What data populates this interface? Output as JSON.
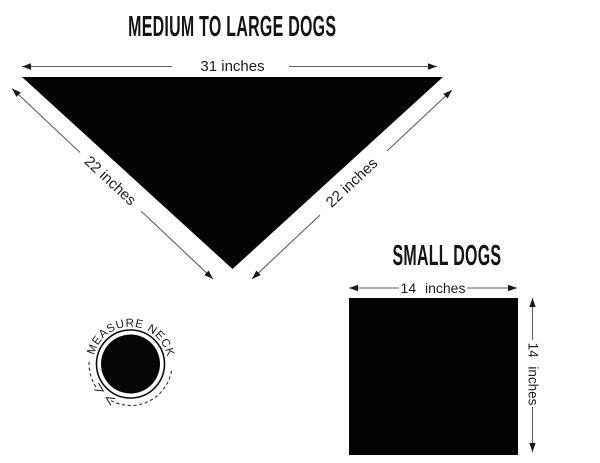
{
  "medium_large": {
    "title": "MEDIUM TO LARGE DOGS",
    "top_label": "31 inches",
    "left_label": "22 inches",
    "right_label": "22 inches"
  },
  "small": {
    "title": "SMALL DOGS",
    "top_label": "14 inches",
    "side_label": "14 inches"
  },
  "badge": {
    "label": "MEASURE NECK"
  },
  "colors": {
    "background": "#ffffff",
    "shape_fill": "#030303",
    "text": "#1c1c1c",
    "dimension_line": "#5f5f5f",
    "arrowhead": "#1a1a1a"
  }
}
